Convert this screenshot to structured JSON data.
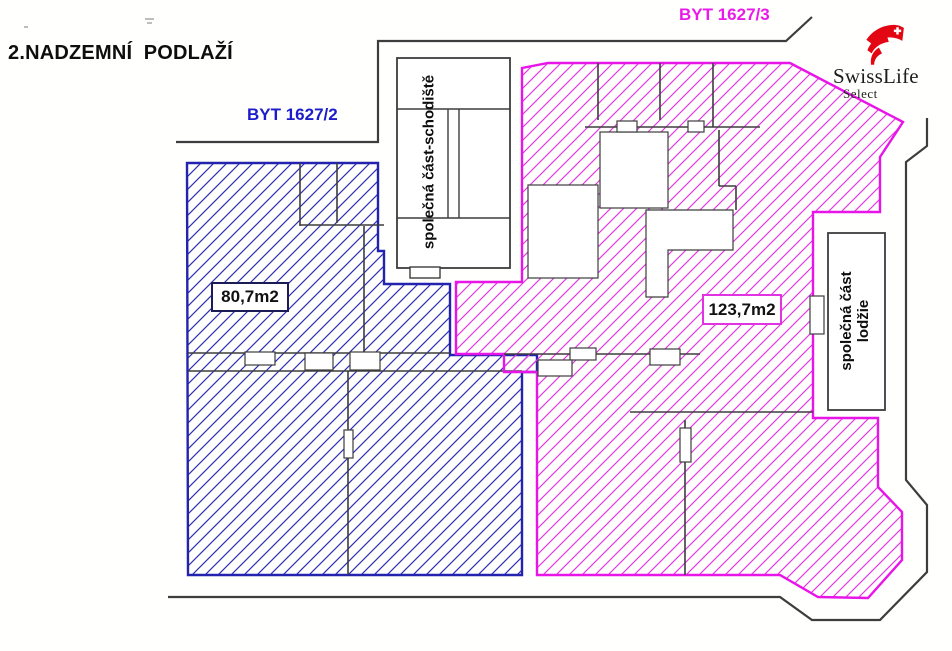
{
  "title": "2.NADZEMNÍ  PODLAŽÍ",
  "plan": {
    "apartments": [
      {
        "id": "byt-1627-2",
        "label": "BYT 1627/2",
        "area": "80,7m2",
        "hatch_color": "#2e2eb4",
        "label_color": "#1c1ccc"
      },
      {
        "id": "byt-1627-3",
        "label": "BYT 1627/3",
        "area": "123,7m2",
        "hatch_color": "#e13ce1",
        "label_color": "#ea1bea"
      }
    ],
    "common_areas": {
      "staircase": "společná část-schodiště",
      "loggia_line1": "společná část",
      "loggia_line2": "lodžie"
    },
    "wall_color": "#3d3d3d"
  },
  "logo": {
    "brand": "SwissLife",
    "sub": "Select",
    "color": "#e30613"
  }
}
